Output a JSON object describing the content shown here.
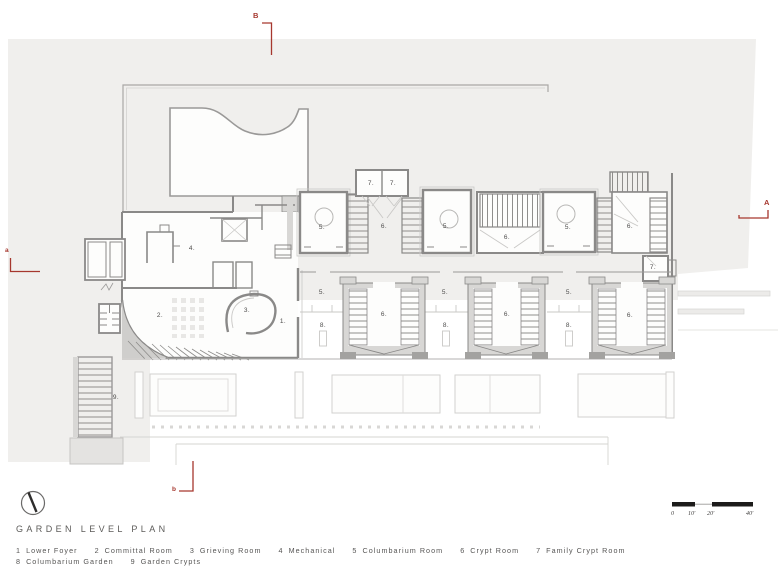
{
  "sheet": {
    "title": "GARDEN LEVEL PLAN",
    "background": "#ffffff",
    "site_fill": "#f0efed",
    "wall_color": "#8a8988",
    "accent_red": "#a6372e"
  },
  "legend": {
    "rows": [
      [
        {
          "num": "1",
          "label": "Lower Foyer"
        },
        {
          "num": "2",
          "label": "Committal Room"
        },
        {
          "num": "3",
          "label": "Grieving Room"
        },
        {
          "num": "4",
          "label": "Mechanical"
        },
        {
          "num": "5",
          "label": "Columbarium Room"
        },
        {
          "num": "6",
          "label": "Crypt Room"
        },
        {
          "num": "7",
          "label": "Family Crypt Room"
        }
      ],
      [
        {
          "num": "8",
          "label": "Columbarium Garden"
        },
        {
          "num": "9",
          "label": "Garden Crypts"
        }
      ]
    ]
  },
  "section_markers": {
    "top": "B",
    "right": "A",
    "left": "a",
    "bottom": "b"
  },
  "scale_bar": {
    "labels": [
      "0",
      "10'",
      "20'",
      "40'"
    ]
  },
  "plan": {
    "room_labels": [
      {
        "t": "1.",
        "x": 283,
        "y": 322
      },
      {
        "t": "2.",
        "x": 160,
        "y": 316
      },
      {
        "t": "3.",
        "x": 247,
        "y": 311
      },
      {
        "t": "4.",
        "x": 192,
        "y": 249
      },
      {
        "t": "5.",
        "x": 322,
        "y": 228
      },
      {
        "t": "5.",
        "x": 446,
        "y": 227
      },
      {
        "t": "5.",
        "x": 568,
        "y": 228
      },
      {
        "t": "6.",
        "x": 384,
        "y": 227
      },
      {
        "t": "6.",
        "x": 507,
        "y": 238
      },
      {
        "t": "6.",
        "x": 630,
        "y": 227
      },
      {
        "t": "7.",
        "x": 371,
        "y": 184
      },
      {
        "t": "7.",
        "x": 393,
        "y": 184
      },
      {
        "t": "7.",
        "x": 653,
        "y": 268
      },
      {
        "t": "5.",
        "x": 322,
        "y": 293
      },
      {
        "t": "5.",
        "x": 445,
        "y": 293
      },
      {
        "t": "5.",
        "x": 569,
        "y": 293
      },
      {
        "t": "8.",
        "x": 323,
        "y": 326
      },
      {
        "t": "8.",
        "x": 446,
        "y": 326
      },
      {
        "t": "8.",
        "x": 569,
        "y": 326
      },
      {
        "t": "6.",
        "x": 384,
        "y": 315
      },
      {
        "t": "6.",
        "x": 507,
        "y": 315
      },
      {
        "t": "6.",
        "x": 630,
        "y": 316
      },
      {
        "t": "9.",
        "x": 116,
        "y": 398
      }
    ]
  }
}
